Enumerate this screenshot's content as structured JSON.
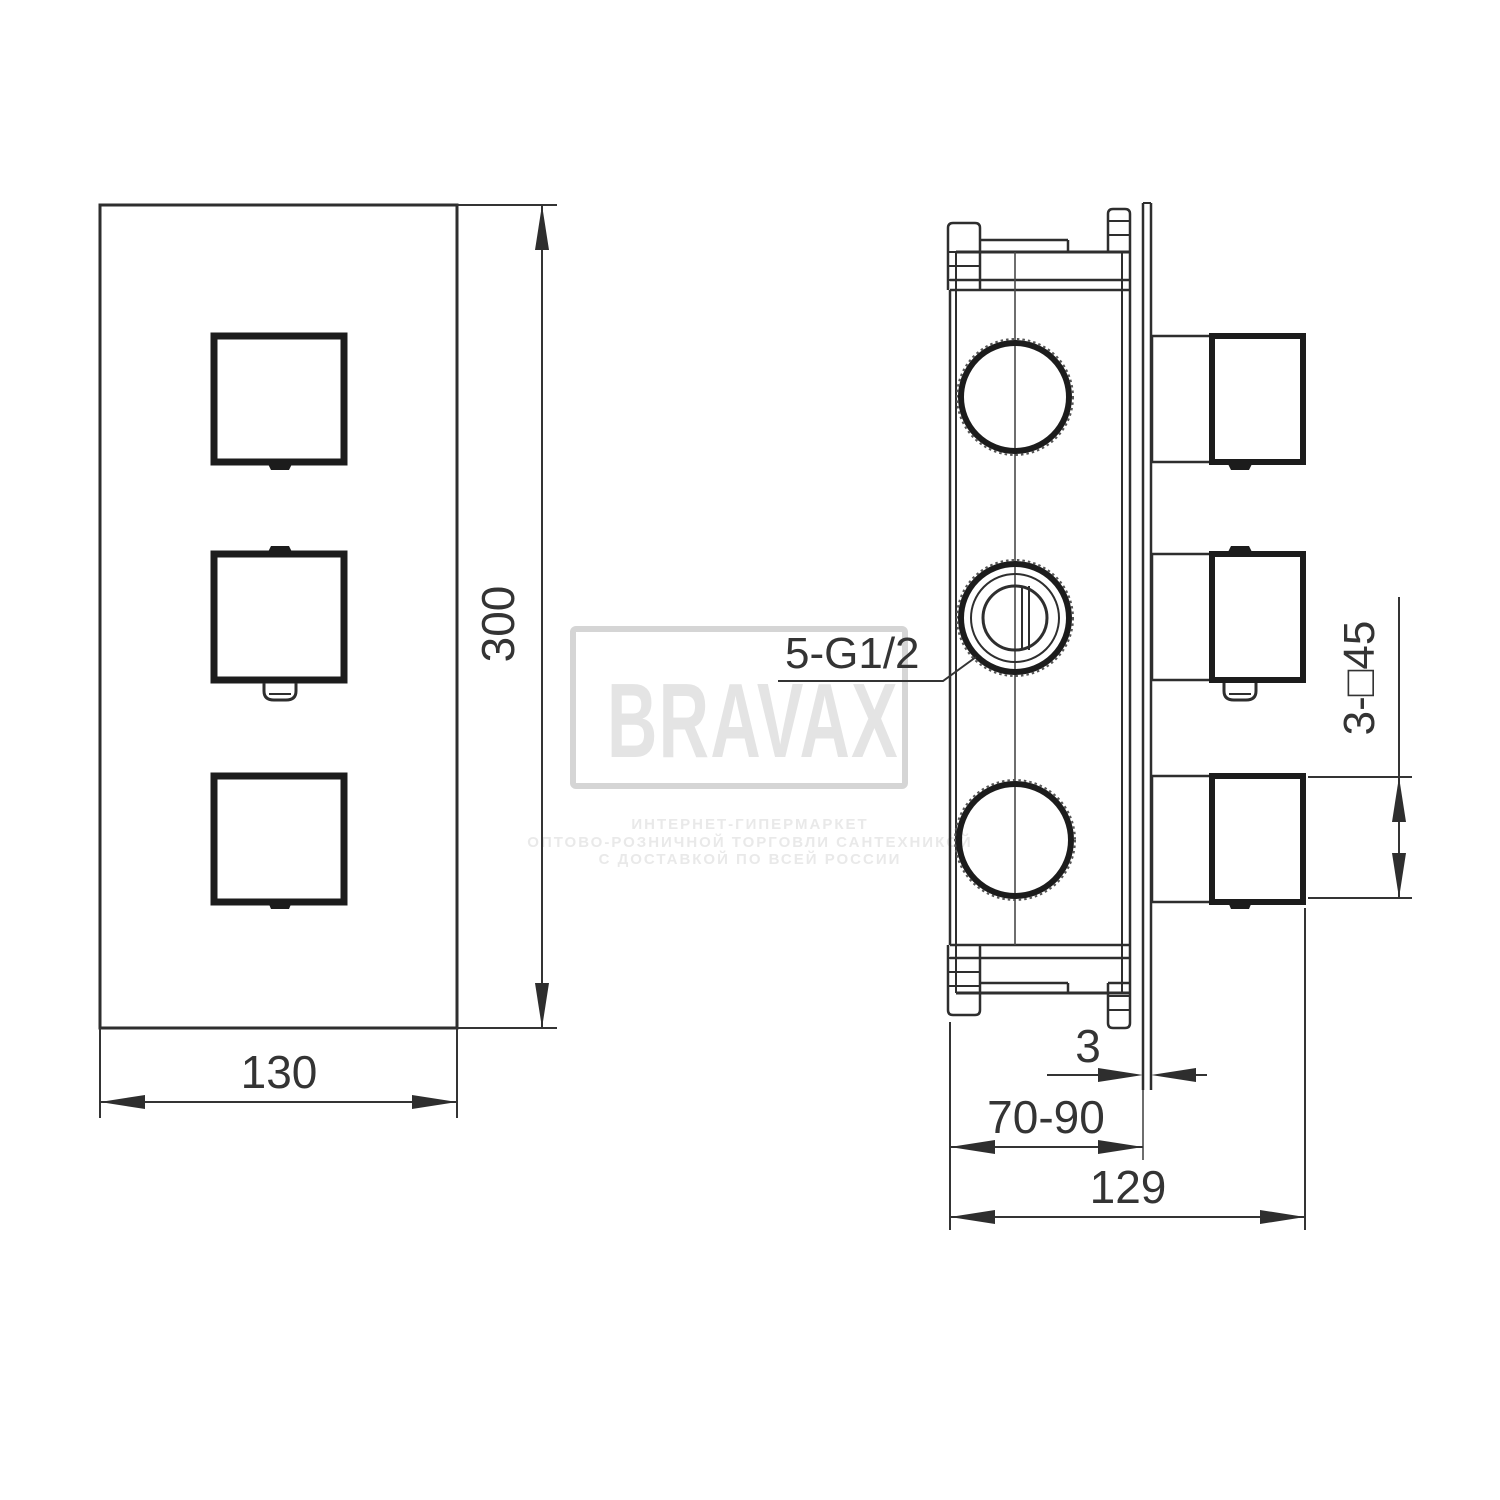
{
  "title": "Concealed thermostatic shower valve technical drawing",
  "watermark": {
    "brand": "BRAVAX",
    "line1": "ИНТЕРНЕТ-ГИПЕРМАРКЕТ",
    "line2": "ОПТОВО-РОЗНИЧНОЙ ТОРГОВЛИ САНТЕХНИКОЙ",
    "line3": "С ДОСТАВКОЙ ПО ВСЕЙ РОССИИ"
  },
  "front_view": {
    "height": "300",
    "width": "130"
  },
  "side_view": {
    "ports": "5-G1/2",
    "handle_size": "3-□45",
    "plate_thickness": "3",
    "mounting_depth": "70-90",
    "overall_depth": "129"
  },
  "colors": {
    "line": "#2e2e2e",
    "thick_line": "#1c1c1c",
    "dimension_text": "#343434",
    "watermark_text": "#e4e4e4",
    "watermark_border": "#d5d5d5",
    "background": "#ffffff"
  }
}
